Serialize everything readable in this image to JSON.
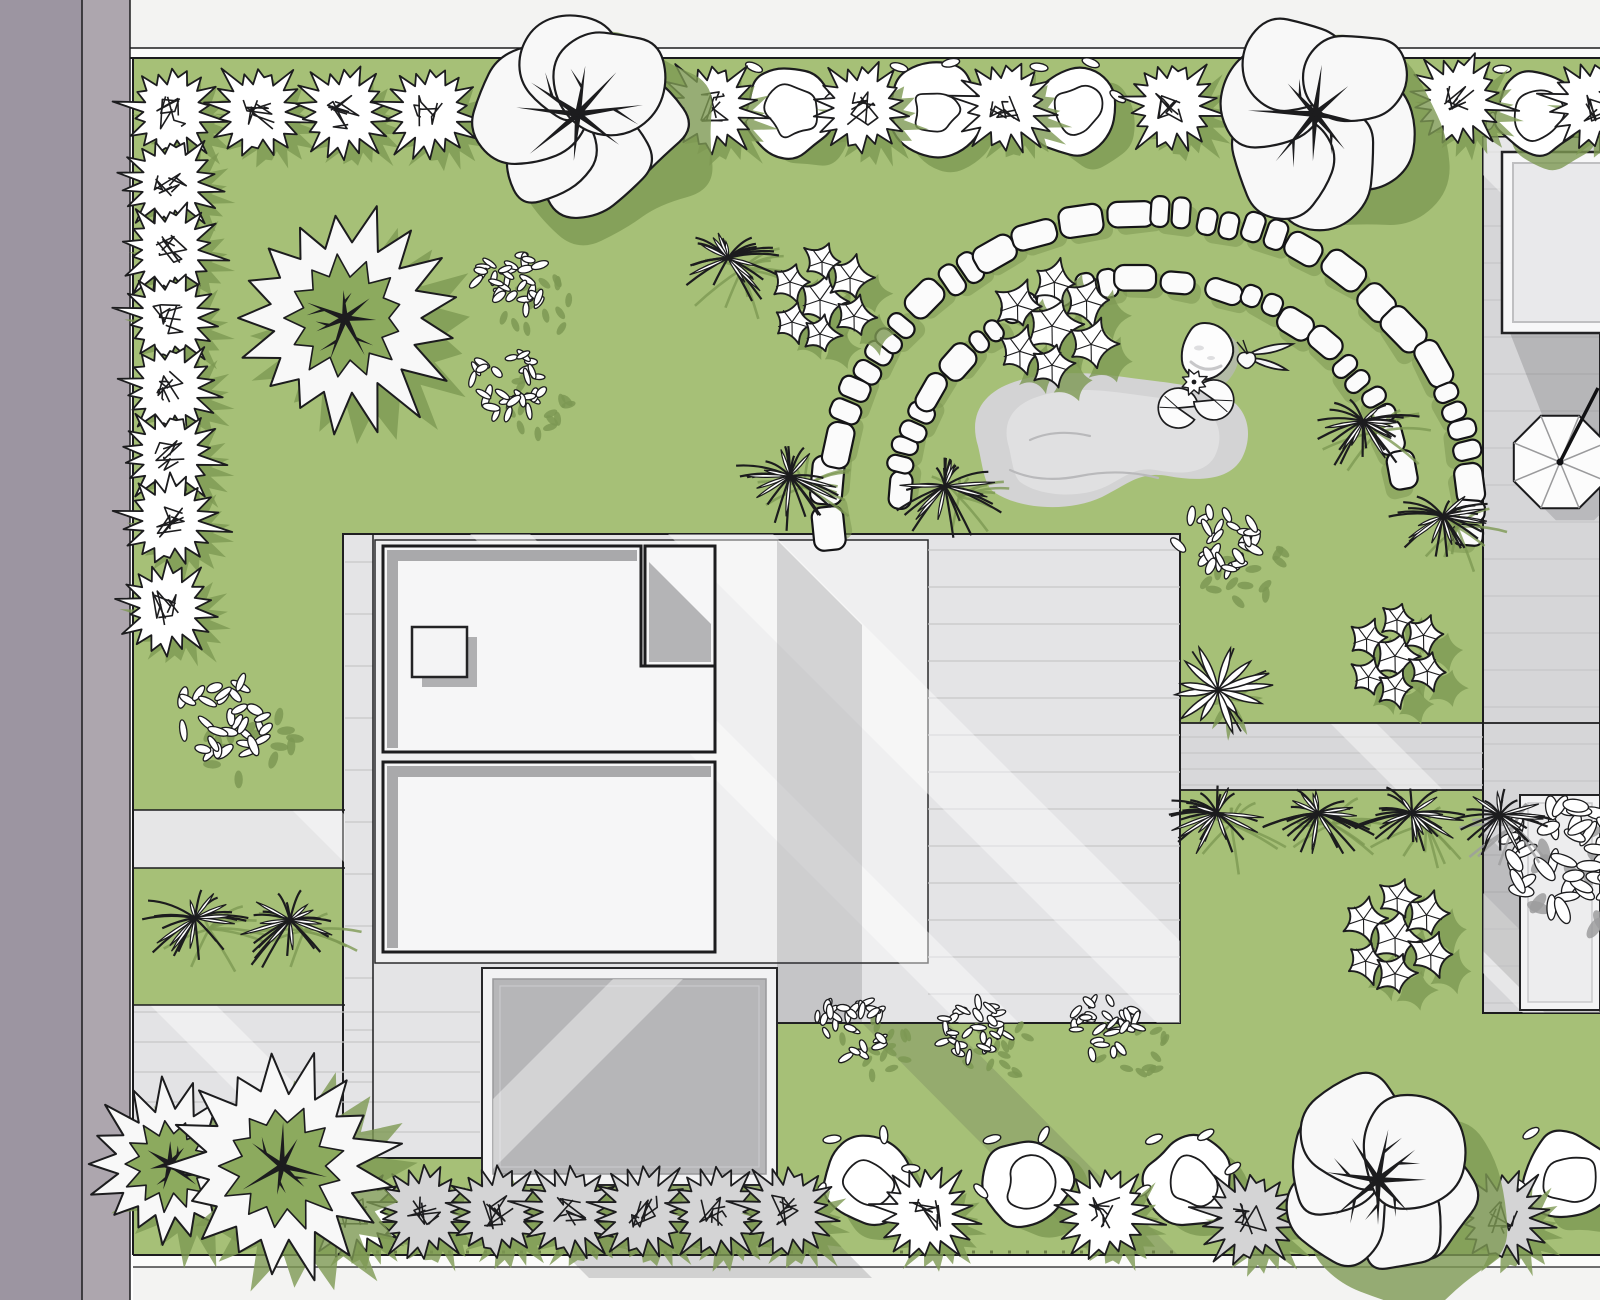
{
  "title": "Residential garden landscape plan, top view",
  "canvas": {
    "w": 1600,
    "h": 1300
  },
  "palette": {
    "bg": "#ffffff",
    "lawn": "#a6c077",
    "lawnShadow": "#7d9853",
    "treeGreen": "#8caa5e",
    "roadDark": "#9c95a1",
    "roadCurb": "#ada6ae",
    "sidewalk": "#f3f3f2",
    "sidewalkLight": "#fbfbfa",
    "patio": "#e4e4e6",
    "strip": "#e0e0e1",
    "deck": "#d6d6d8",
    "walk": "#d8d8da",
    "drive": "#e6e6e7",
    "paveBL": "#e3e3e5",
    "margin": "#efeff0",
    "room": "#f6f6f7",
    "roomShade": "#a9a9ab",
    "garageInner": "#b6b6b8",
    "frame": "#f2f2f3",
    "pond": "#d3d3d4",
    "pondLight": "#e0e0e1",
    "pondLine": "#b9b9bb",
    "stone": "#fbfbfb",
    "ink": "#1c1c1e",
    "plank": "#c6c6c8",
    "grayPlant": "#d4d4d5",
    "grayShadow": "#9c9c9e",
    "shadowNeutral": "#39393b"
  },
  "ground": {
    "lawn": {
      "x": 133,
      "y": 58,
      "w": 1467,
      "h": 1197
    },
    "road": [
      {
        "name": "road-asphalt",
        "x": 0,
        "y": 0,
        "w": 82,
        "h": 1300,
        "fill": "roadDark"
      },
      {
        "name": "road-curb",
        "x": 82,
        "y": 0,
        "w": 48,
        "h": 1300,
        "fill": "roadCurb"
      }
    ],
    "sidewalkTop": [
      {
        "x": 130,
        "y": 0,
        "w": 1470,
        "h": 48,
        "fill": "sidewalk"
      },
      {
        "x": 130,
        "y": 48,
        "w": 1470,
        "h": 10,
        "fill": "sidewalkLight"
      }
    ],
    "sidewalkBottom": [
      {
        "x": 133,
        "y": 1255,
        "w": 1467,
        "h": 12,
        "fill": "sidewalkLight"
      },
      {
        "x": 133,
        "y": 1267,
        "w": 1467,
        "h": 33,
        "fill": "sidewalk"
      }
    ],
    "walkBand": {
      "x": 1180,
      "y": 723,
      "w": 303,
      "h": 67
    },
    "deck": {
      "x": 1483,
      "y": 137,
      "w": 117,
      "h": 876
    },
    "drive": {
      "x": 133,
      "y": 810,
      "w": 212,
      "h": 58
    },
    "paveBL": {
      "x": 133,
      "y": 1005,
      "w": 212,
      "h": 153
    },
    "patioPoly": [
      [
        343,
        534
      ],
      [
        1180,
        534
      ],
      [
        1180,
        1023
      ],
      [
        482,
        1023
      ],
      [
        482,
        1158
      ],
      [
        343,
        1158
      ]
    ],
    "marginRect": {
      "x": 375,
      "y": 540,
      "w": 553,
      "h": 423
    },
    "planks": [
      {
        "x0": 1484,
        "x1": 1599,
        "y0": 152,
        "y1": 1010,
        "gap": 37
      },
      {
        "x0": 928,
        "x1": 1180,
        "y0": 550,
        "y1": 1018,
        "gap": 37
      },
      {
        "x0": 345,
        "x1": 373,
        "y0": 562,
        "y1": 1152,
        "gap": 52
      },
      {
        "x0": 134,
        "x1": 480,
        "y0": 1012,
        "y1": 1152,
        "gap": 30
      },
      {
        "x0": 1181,
        "x1": 1483,
        "y0": 737,
        "y1": 785,
        "gap": 16
      }
    ],
    "lines": [
      {
        "x1": 133,
        "y1": 58,
        "x2": 133,
        "y2": 1255,
        "w": 2
      },
      {
        "x1": 82,
        "y1": 0,
        "x2": 82,
        "y2": 1300,
        "w": 1.5
      },
      {
        "x1": 130,
        "y1": 0,
        "x2": 130,
        "y2": 1300,
        "w": 1.5
      },
      {
        "x1": 130,
        "y1": 48,
        "x2": 1600,
        "y2": 48,
        "w": 1.5
      },
      {
        "x1": 130,
        "y1": 58,
        "x2": 1600,
        "y2": 58,
        "w": 2
      },
      {
        "x1": 133,
        "y1": 810,
        "x2": 345,
        "y2": 810,
        "w": 1.5
      },
      {
        "x1": 133,
        "y1": 868,
        "x2": 345,
        "y2": 868,
        "w": 1.5
      },
      {
        "x1": 133,
        "y1": 1005,
        "x2": 345,
        "y2": 1005,
        "w": 1.5
      },
      {
        "x1": 133,
        "y1": 1158,
        "x2": 482,
        "y2": 1158,
        "w": 1.5
      },
      {
        "x1": 373,
        "y1": 534,
        "x2": 373,
        "y2": 1158,
        "w": 1.5
      },
      {
        "x1": 1180,
        "y1": 723,
        "x2": 1600,
        "y2": 723,
        "w": 1.8
      },
      {
        "x1": 1180,
        "y1": 790,
        "x2": 1483,
        "y2": 790,
        "w": 1.8
      },
      {
        "x1": 133,
        "y1": 1255,
        "x2": 1600,
        "y2": 1255,
        "w": 2
      },
      {
        "x1": 133,
        "y1": 1267,
        "x2": 1600,
        "y2": 1267,
        "w": 1.2
      }
    ],
    "whiteStreaks": [
      {
        "x": 470,
        "y0": 534,
        "y1": 1023,
        "w": 60,
        "clip": "patio"
      },
      {
        "x": 668,
        "y0": 534,
        "y1": 1185,
        "w": 105,
        "clip": "patio"
      },
      {
        "x": 292,
        "y0": 810,
        "y1": 868,
        "w": 48,
        "clip": "drive"
      },
      {
        "x": 150,
        "y0": 1005,
        "y1": 1158,
        "w": 66,
        "clip": "bl"
      },
      {
        "x": 1445,
        "y0": 137,
        "y1": 620,
        "w": 64,
        "clip": "deck"
      },
      {
        "x": 1330,
        "y0": 723,
        "y1": 790,
        "w": 46,
        "clip": "walk"
      },
      {
        "x": 1300,
        "y0": 790,
        "y1": 1013,
        "w": 80,
        "clip": "deck"
      }
    ],
    "darkStreaks": [
      {
        "x": 1255,
        "y0": 723,
        "y1": 1013,
        "w": 120,
        "clip": "deck",
        "op": 0.16
      }
    ],
    "shadows": [
      {
        "pts": [
          [
            777,
            540
          ],
          [
            862,
            625
          ],
          [
            862,
            1023
          ],
          [
            777,
            1023
          ]
        ],
        "op": 0.18
      },
      {
        "pts": [
          [
            497,
            1185
          ],
          [
            780,
            1185
          ],
          [
            872,
            1278
          ],
          [
            589,
            1278
          ]
        ],
        "op": 0.18
      },
      {
        "pts": [
          [
            862,
            1023
          ],
          [
            948,
            1023
          ],
          [
            1178,
            1255
          ],
          [
            1092,
            1255
          ]
        ],
        "op": 0.15
      },
      {
        "pts": [
          [
            1510,
            333
          ],
          [
            1600,
            333
          ],
          [
            1600,
            440
          ],
          [
            1548,
            430
          ]
        ],
        "op": 0.2
      }
    ],
    "fringe": [
      {
        "x1": 340,
        "y1": 1252,
        "x2": 820,
        "y2": 1252
      },
      {
        "x1": 900,
        "y1": 1252,
        "x2": 1180,
        "y2": 1252
      }
    ]
  },
  "house": {
    "room1Poly": [
      [
        383,
        546
      ],
      [
        641,
        546
      ],
      [
        641,
        666
      ],
      [
        715,
        666
      ],
      [
        715,
        752
      ],
      [
        383,
        752
      ]
    ],
    "room1Bands": [
      {
        "x": 387,
        "y": 550,
        "w": 250,
        "h": 11
      },
      {
        "x": 387,
        "y": 550,
        "w": 11,
        "h": 198
      }
    ],
    "smallRoom": {
      "x": 645,
      "y": 546,
      "w": 70,
      "h": 120
    },
    "smallRoomShade": [
      [
        649,
        562
      ],
      [
        711,
        624
      ],
      [
        711,
        662
      ],
      [
        649,
        662
      ]
    ],
    "skylight": {
      "x": 412,
      "y": 627,
      "w": 55,
      "h": 50
    },
    "room2": {
      "x": 383,
      "y": 762,
      "w": 332,
      "h": 190
    },
    "room2Bands": [
      {
        "x": 387,
        "y": 766,
        "w": 324,
        "h": 11
      },
      {
        "x": 387,
        "y": 766,
        "w": 11,
        "h": 182
      }
    ]
  },
  "garage": {
    "frame": {
      "x": 482,
      "y": 968,
      "w": 295,
      "h": 217
    },
    "inner": {
      "x": 493,
      "y": 979,
      "w": 273,
      "h": 195
    },
    "inner2": {
      "x": 500,
      "y": 986,
      "w": 259,
      "h": 181
    }
  },
  "table": {
    "outer": {
      "x": 1502,
      "y": 152,
      "w": 112,
      "h": 181
    },
    "inner": {
      "x": 1513,
      "y": 163,
      "w": 92,
      "h": 159
    }
  },
  "planter": {
    "outer": {
      "x": 1520,
      "y": 795,
      "w": 80,
      "h": 215
    },
    "inner": {
      "x": 1528,
      "y": 803,
      "w": 64,
      "h": 199
    }
  },
  "umbrella": {
    "cx": 1560,
    "cy": 462,
    "r": 50,
    "poleX": 1598,
    "poleY": 388
  },
  "pond": {
    "path": "M 978 446 C 968 414 984 392 1014 382 C 1048 370 1090 372 1124 377 C 1158 382 1196 384 1224 396 C 1248 407 1254 434 1242 458 C 1230 480 1200 482 1168 476 C 1140 471 1128 484 1102 497 C 1068 513 1018 509 994 492 C 984 486 982 462 978 446 Z",
    "squiggles": [
      "M 1010 470 q 30 14 70 6 q 40 -8 78 2",
      "M 1030 440 q 26 -12 60 -4"
    ]
  },
  "rock": {
    "x": 1205,
    "y": 352
  },
  "butterfly": {
    "x": 1247,
    "y": 356
  },
  "lilies": {
    "pads": [
      {
        "x": 1178,
        "y": 408,
        "rot": 15
      },
      {
        "x": 1214,
        "y": 400,
        "rot": 195
      }
    ],
    "flower": {
      "x": 1194,
      "y": 382
    }
  },
  "stones": {
    "cx": 1150,
    "cy": 505,
    "outer": {
      "rx": 320,
      "ry": 290,
      "a0": 176,
      "a1": 364,
      "n": 24,
      "w": 42,
      "h": 28
    },
    "inner": {
      "rx": 253,
      "ry": 225,
      "a0": 183,
      "a1": 352,
      "n": 19,
      "w": 37,
      "h": 25
    }
  },
  "plants": [
    {
      "t": "cluster",
      "x": 512,
      "y": 282,
      "s": 0.85
    },
    {
      "t": "cluster",
      "x": 510,
      "y": 385,
      "s": 0.85
    },
    {
      "t": "cluster",
      "x": 222,
      "y": 720,
      "s": 1.05
    },
    {
      "t": "cluster",
      "x": 1218,
      "y": 545,
      "s": 0.95
    },
    {
      "t": "cluster",
      "x": 850,
      "y": 1028,
      "s": 0.8
    },
    {
      "t": "cluster",
      "x": 975,
      "y": 1032,
      "s": 0.8
    },
    {
      "t": "cluster",
      "x": 1105,
      "y": 1028,
      "s": 0.8
    },
    {
      "t": "cluster",
      "x": 1562,
      "y": 856,
      "s": 1.4,
      "sh": "gray"
    },
    {
      "t": "grass",
      "x": 728,
      "y": 258,
      "s": 1
    },
    {
      "t": "grass",
      "x": 790,
      "y": 476,
      "s": 1
    },
    {
      "t": "grass",
      "x": 945,
      "y": 486,
      "s": 1
    },
    {
      "t": "grass",
      "x": 1363,
      "y": 421,
      "s": 1
    },
    {
      "t": "grass",
      "x": 1443,
      "y": 516,
      "s": 0.9
    },
    {
      "t": "grass",
      "x": 195,
      "y": 918,
      "s": 1
    },
    {
      "t": "grass",
      "x": 290,
      "y": 920,
      "s": 1
    },
    {
      "t": "grass",
      "x": 1217,
      "y": 813,
      "s": 0.95
    },
    {
      "t": "grass",
      "x": 1318,
      "y": 813,
      "s": 0.95
    },
    {
      "t": "grass",
      "x": 1412,
      "y": 813,
      "s": 0.95
    },
    {
      "t": "grass",
      "x": 1500,
      "y": 815,
      "s": 0.9,
      "sh": "gray"
    },
    {
      "t": "hosta",
      "x": 1218,
      "y": 690,
      "s": 1
    },
    {
      "t": "ivy",
      "x": 820,
      "y": 300,
      "s": 1
    },
    {
      "t": "ivy",
      "x": 1052,
      "y": 326,
      "s": 1.15
    },
    {
      "t": "ivy",
      "x": 1395,
      "y": 656,
      "s": 0.95
    },
    {
      "t": "ivy",
      "x": 1395,
      "y": 938,
      "s": 1.05
    },
    {
      "t": "bush",
      "x": 790,
      "y": 110,
      "s": 1
    },
    {
      "t": "bush",
      "x": 935,
      "y": 110,
      "s": 1
    },
    {
      "t": "bush",
      "x": 1075,
      "y": 110,
      "s": 1
    },
    {
      "t": "bush",
      "x": 1538,
      "y": 112,
      "s": 1
    },
    {
      "t": "bush",
      "x": 868,
      "y": 1182,
      "s": 1
    },
    {
      "t": "bush",
      "x": 1028,
      "y": 1182,
      "s": 1
    },
    {
      "t": "bush",
      "x": 1190,
      "y": 1182,
      "s": 1
    },
    {
      "t": "bush",
      "x": 1567,
      "y": 1176,
      "s": 1
    },
    {
      "t": "spiky",
      "x": 172,
      "y": 112,
      "s": 1
    },
    {
      "t": "spiky",
      "x": 258,
      "y": 112,
      "s": 1
    },
    {
      "t": "spiky",
      "x": 344,
      "y": 112,
      "s": 1
    },
    {
      "t": "spiky",
      "x": 430,
      "y": 112,
      "s": 1
    },
    {
      "t": "spiky",
      "x": 712,
      "y": 108,
      "s": 1
    },
    {
      "t": "spiky",
      "x": 862,
      "y": 108,
      "s": 1
    },
    {
      "t": "spiky",
      "x": 1006,
      "y": 106,
      "s": 1
    },
    {
      "t": "spiky",
      "x": 1172,
      "y": 106,
      "s": 1
    },
    {
      "t": "spiky",
      "x": 1458,
      "y": 100,
      "s": 1
    },
    {
      "t": "spiky",
      "x": 1595,
      "y": 104,
      "s": 1
    },
    {
      "t": "spiky",
      "x": 170,
      "y": 182,
      "s": 1
    },
    {
      "t": "spiky",
      "x": 170,
      "y": 250,
      "s": 1
    },
    {
      "t": "spiky",
      "x": 170,
      "y": 318,
      "s": 1
    },
    {
      "t": "spiky",
      "x": 170,
      "y": 388,
      "s": 1
    },
    {
      "t": "spiky",
      "x": 170,
      "y": 455,
      "s": 1
    },
    {
      "t": "spiky",
      "x": 170,
      "y": 521,
      "s": 1
    },
    {
      "t": "spiky",
      "x": 167,
      "y": 608,
      "s": 1
    },
    {
      "t": "spiky",
      "x": 352,
      "y": 1212,
      "s": 1
    },
    {
      "t": "spiky",
      "x": 424,
      "y": 1212,
      "s": 1,
      "g": true
    },
    {
      "t": "spiky",
      "x": 497,
      "y": 1212,
      "s": 1,
      "g": true
    },
    {
      "t": "spiky",
      "x": 570,
      "y": 1212,
      "s": 1,
      "g": true
    },
    {
      "t": "spiky",
      "x": 643,
      "y": 1212,
      "s": 1,
      "g": true
    },
    {
      "t": "spiky",
      "x": 716,
      "y": 1212,
      "s": 1,
      "g": true
    },
    {
      "t": "spiky",
      "x": 788,
      "y": 1212,
      "s": 1,
      "g": true
    },
    {
      "t": "spiky",
      "x": 925,
      "y": 1214,
      "s": 1
    },
    {
      "t": "spiky",
      "x": 1105,
      "y": 1214,
      "s": 1
    },
    {
      "t": "spiky",
      "x": 1250,
      "y": 1218,
      "s": 1,
      "g": true
    },
    {
      "t": "spiky",
      "x": 1502,
      "y": 1218,
      "s": 1,
      "g": true
    },
    {
      "t": "conifer",
      "x": 345,
      "y": 318,
      "s": 1
    },
    {
      "t": "conifer",
      "x": 170,
      "y": 1164,
      "s": 0.72
    },
    {
      "t": "conifer",
      "x": 282,
      "y": 1166,
      "s": 1
    },
    {
      "t": "tree",
      "x": 578,
      "y": 114,
      "s": 1
    },
    {
      "t": "tree",
      "x": 1315,
      "y": 114,
      "s": 1
    },
    {
      "t": "tree",
      "x": 1378,
      "y": 1180,
      "s": 0.95
    }
  ]
}
